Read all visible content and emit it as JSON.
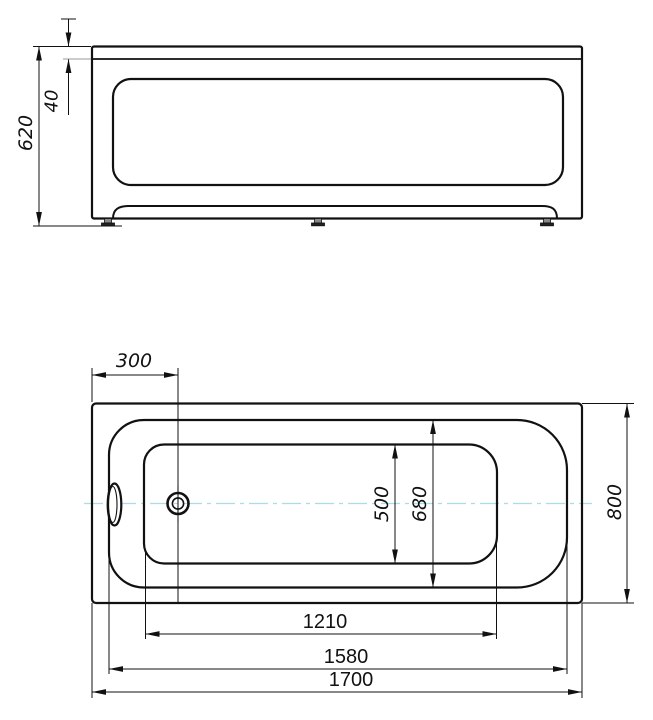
{
  "drawing": {
    "canvas": {
      "width": 653,
      "height": 720,
      "background": "#ffffff"
    },
    "colors": {
      "line": "#111111",
      "centerline": "#a8dce8",
      "aux": "#999999",
      "text": "#111111"
    },
    "views": [
      {
        "id": "front-elevation-view",
        "description": "bathtub front elevation with feet"
      },
      {
        "id": "plan-view",
        "description": "bathtub top view with drain and overflow"
      }
    ],
    "dimensions": {
      "front_view": [
        {
          "value": "620",
          "orientation": "vertical",
          "measures": "overall-height"
        },
        {
          "value": "40",
          "orientation": "vertical",
          "measures": "rim-thickness"
        }
      ],
      "plan_view": [
        {
          "value": "300",
          "orientation": "horizontal",
          "measures": "drain-offset-from-end"
        },
        {
          "value": "500",
          "orientation": "vertical",
          "measures": "basin-bottom-width"
        },
        {
          "value": "680",
          "orientation": "vertical",
          "measures": "basin-top-width"
        },
        {
          "value": "800",
          "orientation": "vertical",
          "measures": "overall-width"
        },
        {
          "value": "1210",
          "orientation": "horizontal",
          "measures": "basin-bottom-length"
        },
        {
          "value": "1580",
          "orientation": "horizontal",
          "measures": "basin-top-length"
        },
        {
          "value": "1700",
          "orientation": "horizontal",
          "measures": "overall-length"
        }
      ]
    },
    "shapes": [
      {
        "type": "rect",
        "name": "front-outer-body",
        "x": 92,
        "y": 46.5,
        "w": 490,
        "h": 172,
        "r": 2,
        "sw": 2.2
      },
      {
        "type": "line",
        "name": "front-rim-line",
        "x1": 92,
        "y1": 59,
        "x2": 582,
        "y2": 59,
        "sw": 1.8
      },
      {
        "type": "rect",
        "name": "front-apron-recess",
        "x": 113,
        "y": 79,
        "w": 450,
        "h": 106,
        "r": 18,
        "sw": 2.2
      },
      {
        "type": "path",
        "name": "front-bottom-lip",
        "d": "M 113 218.5 C 113 209 119 206 129 206 L 542 206 C 552 206 557 209 557 218.5",
        "sw": 2
      },
      {
        "type": "rect",
        "name": "front-foot-left-stem",
        "x": 104.5,
        "y": 218.5,
        "w": 7,
        "h": 4.5,
        "sw": 0.8,
        "fill": "#888888"
      },
      {
        "type": "rect",
        "name": "front-foot-left-base",
        "x": 101.5,
        "y": 223,
        "w": 13,
        "h": 2.8,
        "sw": 0.8,
        "fill": "#222222"
      },
      {
        "type": "rect",
        "name": "front-foot-center-stem",
        "x": 314.5,
        "y": 218.5,
        "w": 7,
        "h": 4.5,
        "sw": 0.8,
        "fill": "#888888"
      },
      {
        "type": "rect",
        "name": "front-foot-center-base",
        "x": 311.5,
        "y": 223,
        "w": 13,
        "h": 2.8,
        "sw": 0.8,
        "fill": "#222222"
      },
      {
        "type": "rect",
        "name": "front-foot-right-stem",
        "x": 543.5,
        "y": 218.5,
        "w": 7,
        "h": 4.5,
        "sw": 0.8,
        "fill": "#888888"
      },
      {
        "type": "rect",
        "name": "front-foot-right-base",
        "x": 540.5,
        "y": 223,
        "w": 13,
        "h": 2.8,
        "sw": 0.8,
        "fill": "#222222"
      },
      {
        "type": "line",
        "name": "dim-620-ext-top",
        "x1": 33,
        "y1": 46.5,
        "x2": 91,
        "y2": 46.5,
        "sw": 1
      },
      {
        "type": "line",
        "name": "dim-620-ext-floor",
        "x1": 33,
        "y1": 226,
        "x2": 122,
        "y2": 226,
        "sw": 1
      },
      {
        "type": "line",
        "name": "dim-620-line",
        "x1": 39,
        "y1": 46.5,
        "x2": 39,
        "y2": 226,
        "sw": 1
      },
      {
        "type": "arrow",
        "name": "dim-620-arrow-top",
        "x": 39,
        "y": 46.5,
        "dir": "up"
      },
      {
        "type": "arrow",
        "name": "dim-620-arrow-bottom",
        "x": 39,
        "y": 226,
        "dir": "down"
      },
      {
        "type": "label",
        "name": "dim-620-label",
        "text": "620",
        "x": 26,
        "y": 133,
        "rot": -90,
        "style": "italic",
        "size": 19
      },
      {
        "type": "line",
        "name": "dim-40-tail-tick",
        "x1": 61,
        "y1": 19,
        "x2": 76,
        "y2": 19,
        "sw": 1
      },
      {
        "type": "line",
        "name": "dim-40-line-upper",
        "x1": 68.5,
        "y1": 19,
        "x2": 68.5,
        "y2": 46.5,
        "sw": 1
      },
      {
        "type": "line",
        "name": "dim-40-line-lower",
        "x1": 68.5,
        "y1": 59,
        "x2": 68.5,
        "y2": 115,
        "sw": 1
      },
      {
        "type": "arrow",
        "name": "dim-40-arrow-upper",
        "x": 68.5,
        "y": 46.5,
        "dir": "down"
      },
      {
        "type": "arrow",
        "name": "dim-40-arrow-lower",
        "x": 68.5,
        "y": 59,
        "dir": "up"
      },
      {
        "type": "line",
        "name": "dim-40-ext-rim",
        "x1": 63,
        "y1": 59,
        "x2": 91,
        "y2": 59,
        "sw": 1,
        "color": "#999999"
      },
      {
        "type": "label",
        "name": "dim-40-label",
        "text": "40",
        "x": 52,
        "y": 101,
        "rot": -90,
        "style": "italic",
        "size": 18
      },
      {
        "type": "line",
        "name": "centerline-horizontal",
        "x1": 84,
        "y1": 503.5,
        "x2": 592,
        "y2": 503.5,
        "sw": 1.3,
        "color": "#a8dce8",
        "dash": "19 5 4 5"
      },
      {
        "type": "line",
        "name": "centerline-drain-vertical",
        "x1": 178,
        "y1": 486,
        "x2": 178,
        "y2": 522,
        "sw": 1.3,
        "color": "#a8dce8",
        "dash": "9 4 3 4"
      },
      {
        "type": "rect",
        "name": "plan-outer-body",
        "x": 92,
        "y": 403.5,
        "w": 490,
        "h": 199.5,
        "r": 4,
        "sw": 2.2
      },
      {
        "type": "path",
        "name": "plan-rim-outline",
        "d": "M 144 420 L 517 420 A 50 50 0 0 1 567 470 L 567 537.5 A 50 50 0 0 1 517 587.5 L 144 587.5 A 35 35 0 0 1 109 552.5 L 109 455 A 35 35 0 0 1 144 420 Z",
        "sw": 2.2
      },
      {
        "type": "path",
        "name": "plan-basin-outline",
        "d": "M 164 444.5 L 469 444.5 A 28 28 0 0 1 497 472.5 L 497 535.5 A 28 28 0 0 1 469 563.5 L 164 563.5 A 20 20 0 0 1 144 543.5 L 144 464.5 A 20 20 0 0 1 164 444.5 Z",
        "sw": 2.2
      },
      {
        "type": "line",
        "name": "dim-300-ext-drain-line",
        "x1": 178,
        "y1": 368,
        "x2": 178,
        "y2": 603,
        "sw": 1
      },
      {
        "type": "circle",
        "name": "drain-outer-circle",
        "cx": 178,
        "cy": 503.5,
        "r": 10.5,
        "sw": 2.6
      },
      {
        "type": "circle",
        "name": "drain-inner-circle",
        "cx": 178,
        "cy": 503.5,
        "r": 5.6,
        "sw": 1.6
      },
      {
        "type": "ellipse",
        "name": "overflow-outer-oval",
        "cx": 114.5,
        "cy": 504.5,
        "rx": 6.8,
        "ry": 21,
        "sw": 2.2,
        "fill": "#ffffff"
      },
      {
        "type": "ellipse",
        "name": "overflow-inner-oval",
        "cx": 112.8,
        "cy": 504.5,
        "rx": 4.2,
        "ry": 18,
        "sw": 1.1
      },
      {
        "type": "line",
        "name": "dim-300-ext-left",
        "x1": 92,
        "y1": 368,
        "x2": 92,
        "y2": 402,
        "sw": 1
      },
      {
        "type": "line",
        "name": "dim-300-line",
        "x1": 92,
        "y1": 375,
        "x2": 178,
        "y2": 375,
        "sw": 1
      },
      {
        "type": "arrow",
        "name": "dim-300-arrow-left",
        "x": 92,
        "y": 375,
        "dir": "left"
      },
      {
        "type": "arrow",
        "name": "dim-300-arrow-right",
        "x": 178,
        "y": 375,
        "dir": "right"
      },
      {
        "type": "label",
        "name": "dim-300-label",
        "text": "300",
        "x": 134,
        "y": 361,
        "rot": 0,
        "style": "italic",
        "size": 19
      },
      {
        "type": "line",
        "name": "dim-800-ext-top",
        "x1": 582,
        "y1": 403.5,
        "x2": 634,
        "y2": 403.5,
        "sw": 1
      },
      {
        "type": "line",
        "name": "dim-800-ext-bottom",
        "x1": 582,
        "y1": 603,
        "x2": 634,
        "y2": 603,
        "sw": 1
      },
      {
        "type": "line",
        "name": "dim-800-line",
        "x1": 627,
        "y1": 403.5,
        "x2": 627,
        "y2": 603,
        "sw": 1
      },
      {
        "type": "arrow",
        "name": "dim-800-arrow-top",
        "x": 627,
        "y": 403.5,
        "dir": "up"
      },
      {
        "type": "arrow",
        "name": "dim-800-arrow-bottom",
        "x": 627,
        "y": 603,
        "dir": "down"
      },
      {
        "type": "label",
        "name": "dim-800-label",
        "text": "800",
        "x": 615,
        "y": 502,
        "rot": -90,
        "style": "italic",
        "size": 19
      },
      {
        "type": "line",
        "name": "dim-680-line",
        "x1": 433,
        "y1": 420,
        "x2": 433,
        "y2": 587.5,
        "sw": 1
      },
      {
        "type": "arrow",
        "name": "dim-680-arrow-top",
        "x": 433,
        "y": 420,
        "dir": "up"
      },
      {
        "type": "arrow",
        "name": "dim-680-arrow-bottom",
        "x": 433,
        "y": 587.5,
        "dir": "down"
      },
      {
        "type": "label",
        "name": "dim-680-label",
        "text": "680",
        "x": 420,
        "y": 504,
        "rot": -90,
        "style": "italic",
        "size": 19
      },
      {
        "type": "line",
        "name": "dim-500-line",
        "x1": 395,
        "y1": 444.5,
        "x2": 395,
        "y2": 563.5,
        "sw": 1
      },
      {
        "type": "arrow",
        "name": "dim-500-arrow-top",
        "x": 395,
        "y": 444.5,
        "dir": "up"
      },
      {
        "type": "arrow",
        "name": "dim-500-arrow-bottom",
        "x": 395,
        "y": 563.5,
        "dir": "down"
      },
      {
        "type": "label",
        "name": "dim-500-label",
        "text": "500",
        "x": 382,
        "y": 504,
        "rot": -90,
        "style": "italic",
        "size": 19
      },
      {
        "type": "line",
        "name": "dim-1210-ext-left",
        "x1": 145.5,
        "y1": 552,
        "x2": 145.5,
        "y2": 639,
        "sw": 1
      },
      {
        "type": "line",
        "name": "dim-1210-ext-right",
        "x1": 496.5,
        "y1": 542,
        "x2": 496.5,
        "y2": 639,
        "sw": 1
      },
      {
        "type": "line",
        "name": "dim-1210-line",
        "x1": 145.5,
        "y1": 634,
        "x2": 496.5,
        "y2": 634,
        "sw": 1
      },
      {
        "type": "arrow",
        "name": "dim-1210-arrow-left",
        "x": 145.5,
        "y": 634,
        "dir": "left"
      },
      {
        "type": "arrow",
        "name": "dim-1210-arrow-right",
        "x": 496.5,
        "y": 634,
        "dir": "right"
      },
      {
        "type": "label",
        "name": "dim-1210-label",
        "text": "1210",
        "x": 325,
        "y": 622,
        "rot": 0,
        "style": "upright",
        "size": 20
      },
      {
        "type": "line",
        "name": "dim-1580-ext-left",
        "x1": 109,
        "y1": 558,
        "x2": 109,
        "y2": 674,
        "sw": 1
      },
      {
        "type": "line",
        "name": "dim-1580-ext-right",
        "x1": 567,
        "y1": 545,
        "x2": 567,
        "y2": 674,
        "sw": 1
      },
      {
        "type": "line",
        "name": "dim-1580-line",
        "x1": 109,
        "y1": 669,
        "x2": 567,
        "y2": 669,
        "sw": 1
      },
      {
        "type": "arrow",
        "name": "dim-1580-arrow-left",
        "x": 109,
        "y": 669,
        "dir": "left"
      },
      {
        "type": "arrow",
        "name": "dim-1580-arrow-right",
        "x": 567,
        "y": 669,
        "dir": "right"
      },
      {
        "type": "label",
        "name": "dim-1580-label",
        "text": "1580",
        "x": 346,
        "y": 657,
        "rot": 0,
        "style": "upright",
        "size": 20
      },
      {
        "type": "line",
        "name": "dim-1700-ext-left",
        "x1": 92,
        "y1": 603,
        "x2": 92,
        "y2": 698,
        "sw": 1
      },
      {
        "type": "line",
        "name": "dim-1700-ext-right",
        "x1": 582,
        "y1": 603,
        "x2": 582,
        "y2": 698,
        "sw": 1
      },
      {
        "type": "line",
        "name": "dim-1700-line",
        "x1": 92,
        "y1": 692,
        "x2": 582,
        "y2": 692,
        "sw": 1
      },
      {
        "type": "arrow",
        "name": "dim-1700-arrow-left",
        "x": 92,
        "y": 692,
        "dir": "left"
      },
      {
        "type": "arrow",
        "name": "dim-1700-arrow-right",
        "x": 582,
        "y": 692,
        "dir": "right"
      },
      {
        "type": "label",
        "name": "dim-1700-label",
        "text": "1700",
        "x": 351,
        "y": 680,
        "rot": 0,
        "style": "upright",
        "size": 20
      }
    ]
  }
}
